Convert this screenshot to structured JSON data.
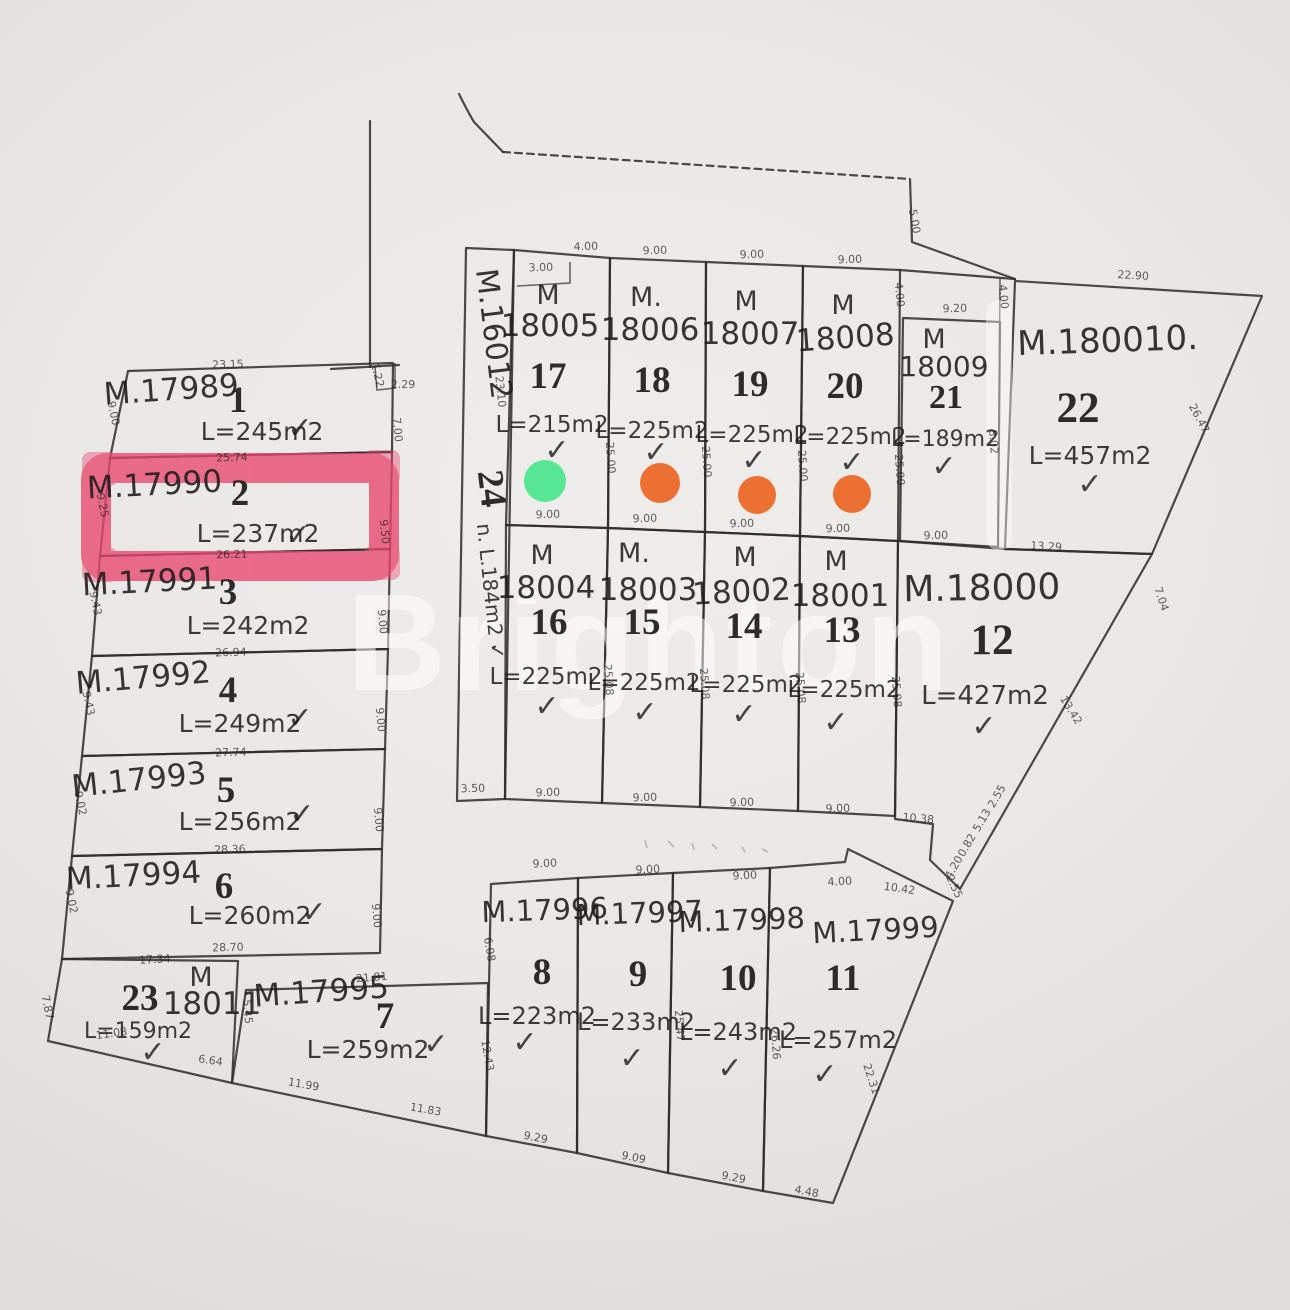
{
  "watermark": "Brighton",
  "colors": {
    "highlight": "#e8476e",
    "green_dot": "#57e694",
    "orange_dot": "#ed7033",
    "ink": "#2e2c2a"
  },
  "lots": [
    {
      "num": "1",
      "certA": "",
      "certB": "M.17989",
      "area": "L=245m2",
      "check": "✓"
    },
    {
      "num": "2",
      "certA": "",
      "certB": "M.17990",
      "area": "L=237m2",
      "check": "✓"
    },
    {
      "num": "3",
      "certA": "",
      "certB": "M.17991",
      "area": "L=242m2",
      "check": ""
    },
    {
      "num": "4",
      "certA": "",
      "certB": "M.17992",
      "area": "L=249m2",
      "check": "✓"
    },
    {
      "num": "5",
      "certA": "",
      "certB": "M.17993",
      "area": "L=256m2",
      "check": "✓"
    },
    {
      "num": "6",
      "certA": "",
      "certB": "M.17994",
      "area": "L=260m2",
      "check": "✓"
    },
    {
      "num": "7",
      "certA": "",
      "certB": "M.17995",
      "area": "L=259m2",
      "check": "✓"
    },
    {
      "num": "8",
      "certA": "",
      "certB": "M.17996",
      "area": "L=223m2",
      "check": "✓"
    },
    {
      "num": "9",
      "certA": "",
      "certB": "M.17997",
      "area": "L=233m2",
      "check": "✓"
    },
    {
      "num": "10",
      "certA": "",
      "certB": "M.17998",
      "area": "L=243m2",
      "check": "✓"
    },
    {
      "num": "11",
      "certA": "",
      "certB": "M.17999",
      "area": "L=257m2",
      "check": "✓"
    },
    {
      "num": "12",
      "certA": "",
      "certB": "M.18000",
      "area": "L=427m2",
      "check": "✓"
    },
    {
      "num": "13",
      "certA": "M",
      "certB": "18001",
      "area": "L=225m2",
      "check": "✓"
    },
    {
      "num": "14",
      "certA": "M",
      "certB": "18002",
      "area": "L=225m2",
      "check": "✓"
    },
    {
      "num": "15",
      "certA": "M.",
      "certB": "18003",
      "area": "L=225m2",
      "check": "✓"
    },
    {
      "num": "16",
      "certA": "M",
      "certB": "18004",
      "area": "L=225m2",
      "check": "✓"
    },
    {
      "num": "17",
      "certA": "M",
      "certB": "18005",
      "area": "L=215m2",
      "check": "✓",
      "dot": "green"
    },
    {
      "num": "18",
      "certA": "M.",
      "certB": "18006",
      "area": "L=225m2",
      "check": "✓",
      "dot": "orange"
    },
    {
      "num": "19",
      "certA": "M",
      "certB": "18007",
      "area": "L=225m2",
      "check": "✓",
      "dot": "orange"
    },
    {
      "num": "20",
      "certA": "M",
      "certB": "18008",
      "area": "L=225m2",
      "check": "✓",
      "dot": "orange"
    },
    {
      "num": "21",
      "certA": "M",
      "certB": "18009",
      "area": "L=189m2",
      "check": "✓"
    },
    {
      "num": "22",
      "certA": "",
      "certB": "M.180010.",
      "area": "L=457m2",
      "check": "✓"
    },
    {
      "num": "23",
      "certA": "M",
      "certB": "18011",
      "area": "L=159m2",
      "check": "✓"
    },
    {
      "num": "24",
      "certA": "",
      "certB": "M.16012",
      "area": "n. L.184m2 ✓",
      "check": ""
    }
  ],
  "dims": [
    {
      "t": "23.15",
      "x": 228,
      "y": 368,
      "r": -2
    },
    {
      "t": "1.22",
      "x": 374,
      "y": 376,
      "r": 75
    },
    {
      "t": "2.29",
      "x": 403,
      "y": 388,
      "r": 0
    },
    {
      "t": "7.00",
      "x": 394,
      "y": 430,
      "r": 85
    },
    {
      "t": "9.00",
      "x": 110,
      "y": 414,
      "r": 78
    },
    {
      "t": "25.74",
      "x": 232,
      "y": 461,
      "r": -2
    },
    {
      "t": "9.25",
      "x": 99,
      "y": 506,
      "r": 78
    },
    {
      "t": "9.50",
      "x": 381,
      "y": 532,
      "r": 85
    },
    {
      "t": "26.21",
      "x": 232,
      "y": 558,
      "r": -2
    },
    {
      "t": "9.43",
      "x": 92,
      "y": 604,
      "r": 78
    },
    {
      "t": "9.00",
      "x": 379,
      "y": 622,
      "r": 85
    },
    {
      "t": "26.94",
      "x": 231,
      "y": 656,
      "r": -2
    },
    {
      "t": "9.43",
      "x": 85,
      "y": 704,
      "r": 78
    },
    {
      "t": "9.00",
      "x": 377,
      "y": 720,
      "r": 85
    },
    {
      "t": "27.74",
      "x": 231,
      "y": 756,
      "r": -2
    },
    {
      "t": "9.02",
      "x": 77,
      "y": 804,
      "r": 78
    },
    {
      "t": "9.00",
      "x": 375,
      "y": 820,
      "r": 85
    },
    {
      "t": "28.36",
      "x": 230,
      "y": 853,
      "r": -2
    },
    {
      "t": "9.02",
      "x": 68,
      "y": 902,
      "r": 78
    },
    {
      "t": "9.00",
      "x": 373,
      "y": 916,
      "r": 85
    },
    {
      "t": "28.70",
      "x": 228,
      "y": 951,
      "r": -2
    },
    {
      "t": "17.34",
      "x": 155,
      "y": 963,
      "r": -3
    },
    {
      "t": "5.45",
      "x": 244,
      "y": 1012,
      "r": 85
    },
    {
      "t": "7.87",
      "x": 44,
      "y": 1008,
      "r": 78
    },
    {
      "t": "11.08",
      "x": 112,
      "y": 1037,
      "r": -8
    },
    {
      "t": "6.64",
      "x": 210,
      "y": 1064,
      "r": 8
    },
    {
      "t": "21.81",
      "x": 372,
      "y": 981,
      "r": -5
    },
    {
      "t": "11.99",
      "x": 303,
      "y": 1088,
      "r": 10
    },
    {
      "t": "11.83",
      "x": 425,
      "y": 1113,
      "r": 10
    },
    {
      "t": "23.10",
      "x": 497,
      "y": 392,
      "r": 84
    },
    {
      "t": "3.50",
      "x": 473,
      "y": 792,
      "r": -2
    },
    {
      "t": "3.00",
      "x": 541,
      "y": 271,
      "r": -2
    },
    {
      "t": "4.00",
      "x": 586,
      "y": 250,
      "r": -2
    },
    {
      "t": "9.00",
      "x": 655,
      "y": 254,
      "r": -2
    },
    {
      "t": "9.00",
      "x": 752,
      "y": 258,
      "r": -2
    },
    {
      "t": "9.00",
      "x": 850,
      "y": 263,
      "r": -2
    },
    {
      "t": "5.00",
      "x": 911,
      "y": 222,
      "r": 80
    },
    {
      "t": "4.00",
      "x": 896,
      "y": 295,
      "r": 85
    },
    {
      "t": "4.00",
      "x": 1000,
      "y": 297,
      "r": 85
    },
    {
      "t": "9.20",
      "x": 955,
      "y": 312,
      "r": -2
    },
    {
      "t": "22.90",
      "x": 1133,
      "y": 279,
      "r": 3
    },
    {
      "t": "26.47",
      "x": 1196,
      "y": 420,
      "r": 62
    },
    {
      "t": "25.00",
      "x": 607,
      "y": 458,
      "r": 86
    },
    {
      "t": "25.00",
      "x": 703,
      "y": 462,
      "r": 86
    },
    {
      "t": "25.00",
      "x": 799,
      "y": 466,
      "r": 86
    },
    {
      "t": "25.00",
      "x": 896,
      "y": 470,
      "r": 86
    },
    {
      "t": "8.02",
      "x": 990,
      "y": 442,
      "r": 86
    },
    {
      "t": "9.00",
      "x": 548,
      "y": 518,
      "r": -2
    },
    {
      "t": "9.00",
      "x": 645,
      "y": 522,
      "r": -2
    },
    {
      "t": "9.00",
      "x": 742,
      "y": 527,
      "r": -2
    },
    {
      "t": "9.00",
      "x": 838,
      "y": 532,
      "r": -2
    },
    {
      "t": "9.00",
      "x": 936,
      "y": 539,
      "r": -2
    },
    {
      "t": "13.29",
      "x": 1046,
      "y": 550,
      "r": 3
    },
    {
      "t": "7.04",
      "x": 1158,
      "y": 600,
      "r": 72
    },
    {
      "t": "25.08",
      "x": 605,
      "y": 680,
      "r": 86
    },
    {
      "t": "25.08",
      "x": 701,
      "y": 684,
      "r": 86
    },
    {
      "t": "25.08",
      "x": 797,
      "y": 688,
      "r": 86
    },
    {
      "t": "25.08",
      "x": 893,
      "y": 692,
      "r": 86
    },
    {
      "t": "13.42",
      "x": 1068,
      "y": 712,
      "r": 58
    },
    {
      "t": "9.00",
      "x": 548,
      "y": 796,
      "r": -2
    },
    {
      "t": "9.00",
      "x": 645,
      "y": 801,
      "r": -2
    },
    {
      "t": "9.00",
      "x": 742,
      "y": 806,
      "r": -2
    },
    {
      "t": "9.00",
      "x": 838,
      "y": 812,
      "r": -2
    },
    {
      "t": "10.38",
      "x": 918,
      "y": 822,
      "r": 5
    },
    {
      "t": "2.55",
      "x": 1000,
      "y": 798,
      "r": -60
    },
    {
      "t": "5.13",
      "x": 985,
      "y": 822,
      "r": -60
    },
    {
      "t": "0.82",
      "x": 970,
      "y": 847,
      "r": -60
    },
    {
      "t": "4.20",
      "x": 957,
      "y": 869,
      "r": -60
    },
    {
      "t": "9.00",
      "x": 545,
      "y": 867,
      "r": -3
    },
    {
      "t": "9.00",
      "x": 648,
      "y": 873,
      "r": -3
    },
    {
      "t": "9.00",
      "x": 745,
      "y": 879,
      "r": -3
    },
    {
      "t": "4.00",
      "x": 840,
      "y": 885,
      "r": -3
    },
    {
      "t": "10.42",
      "x": 899,
      "y": 892,
      "r": 8
    },
    {
      "t": "2.55",
      "x": 951,
      "y": 888,
      "r": 65
    },
    {
      "t": "6.08",
      "x": 486,
      "y": 950,
      "r": 80
    },
    {
      "t": "12.43",
      "x": 484,
      "y": 1056,
      "r": 80
    },
    {
      "t": "25.47",
      "x": 676,
      "y": 1026,
      "r": 86
    },
    {
      "t": "26.26",
      "x": 772,
      "y": 1044,
      "r": 86
    },
    {
      "t": "9.29",
      "x": 535,
      "y": 1141,
      "r": 11
    },
    {
      "t": "9.09",
      "x": 633,
      "y": 1161,
      "r": 11
    },
    {
      "t": "9.29",
      "x": 733,
      "y": 1181,
      "r": 11
    },
    {
      "t": "4.48",
      "x": 806,
      "y": 1195,
      "r": 11
    },
    {
      "t": "22.31",
      "x": 868,
      "y": 1080,
      "r": 72
    }
  ]
}
